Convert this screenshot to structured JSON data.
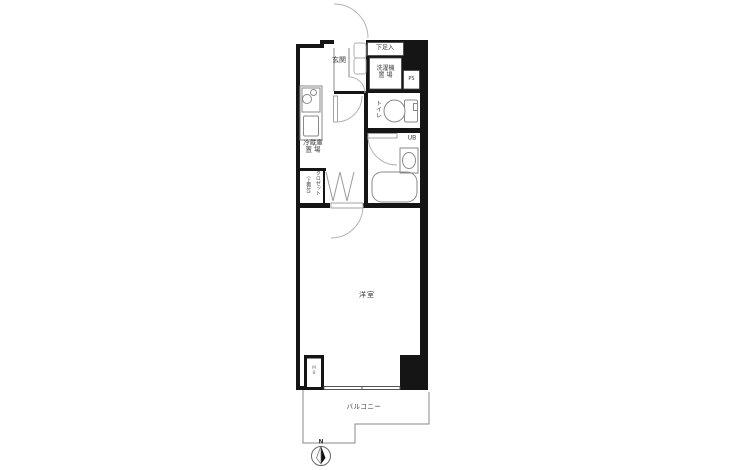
{
  "rooms": {
    "entrance": {
      "label": "玄関"
    },
    "shoe_box": {
      "label": "下足入"
    },
    "washing_machine": {
      "label_line1": "洗濯機",
      "label_line2": "置 場"
    },
    "pipe_space": {
      "label": "PS"
    },
    "toilet": {
      "label": "トイレ"
    },
    "unit_bath": {
      "label": "UB"
    },
    "refrigerator": {
      "label_line1": "冷蔵庫",
      "label_line2": "置 場"
    },
    "closet": {
      "label": "クロゼット",
      "note": "（上棚付）"
    },
    "meter_box": {
      "label": "MB"
    },
    "western_room": {
      "label": "洋室"
    },
    "balcony": {
      "label": "バルコニー"
    }
  },
  "compass": {
    "north_label": "N"
  },
  "colors": {
    "wall": "#151515",
    "thin_line": "#8a8a8a",
    "door_arc": "#b3b3b3",
    "text": "#3a3a3a",
    "background": "#ffffff"
  }
}
